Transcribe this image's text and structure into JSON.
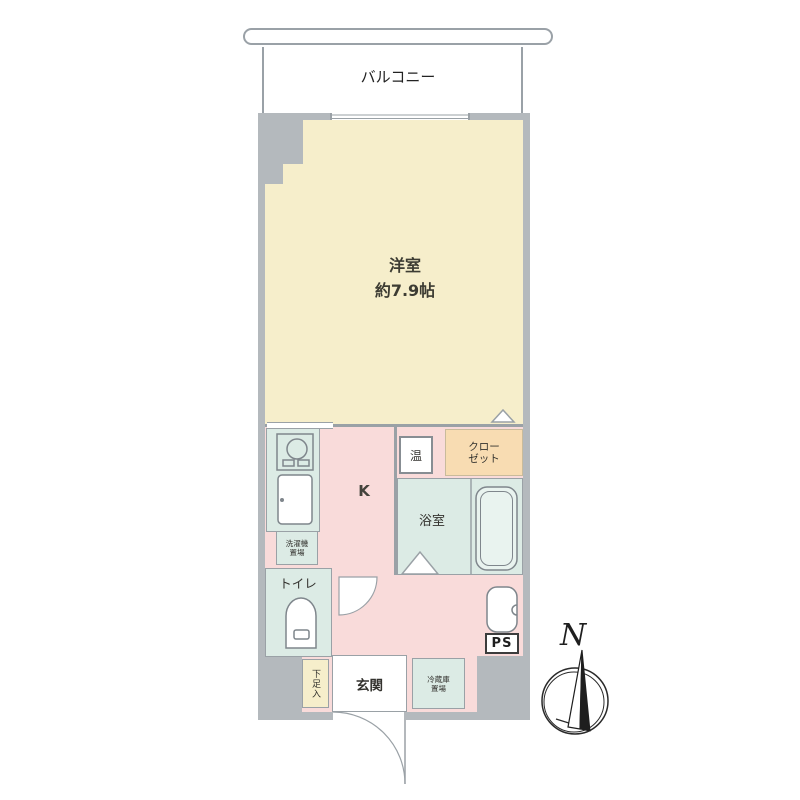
{
  "floorplan": {
    "balcony_label": "バルコニー",
    "main_room": {
      "name": "洋室",
      "size": "約7.9帖"
    },
    "kitchen_label": "K",
    "water_heater_label": "温",
    "closet_label": "クローゼット",
    "bathroom_label": "浴室",
    "toilet_label": "トイレ",
    "washer_space_label": "洗濯機置場",
    "fridge_space_label": "冷蔵庫置場",
    "shoe_cabinet_label": "下足入",
    "entrance_label": "玄関",
    "pipe_space_label": "PS",
    "compass_north_label": "N",
    "colors": {
      "wall_gray": "#b4b9bd",
      "room_cream": "#f6eecb",
      "kitchen_pink": "#f9dbda",
      "wet_area_mint": "#dcebe5",
      "closet_orange": "#f8dcb2",
      "line_gray": "#9aa1a6",
      "text_dark": "#33322e"
    }
  }
}
